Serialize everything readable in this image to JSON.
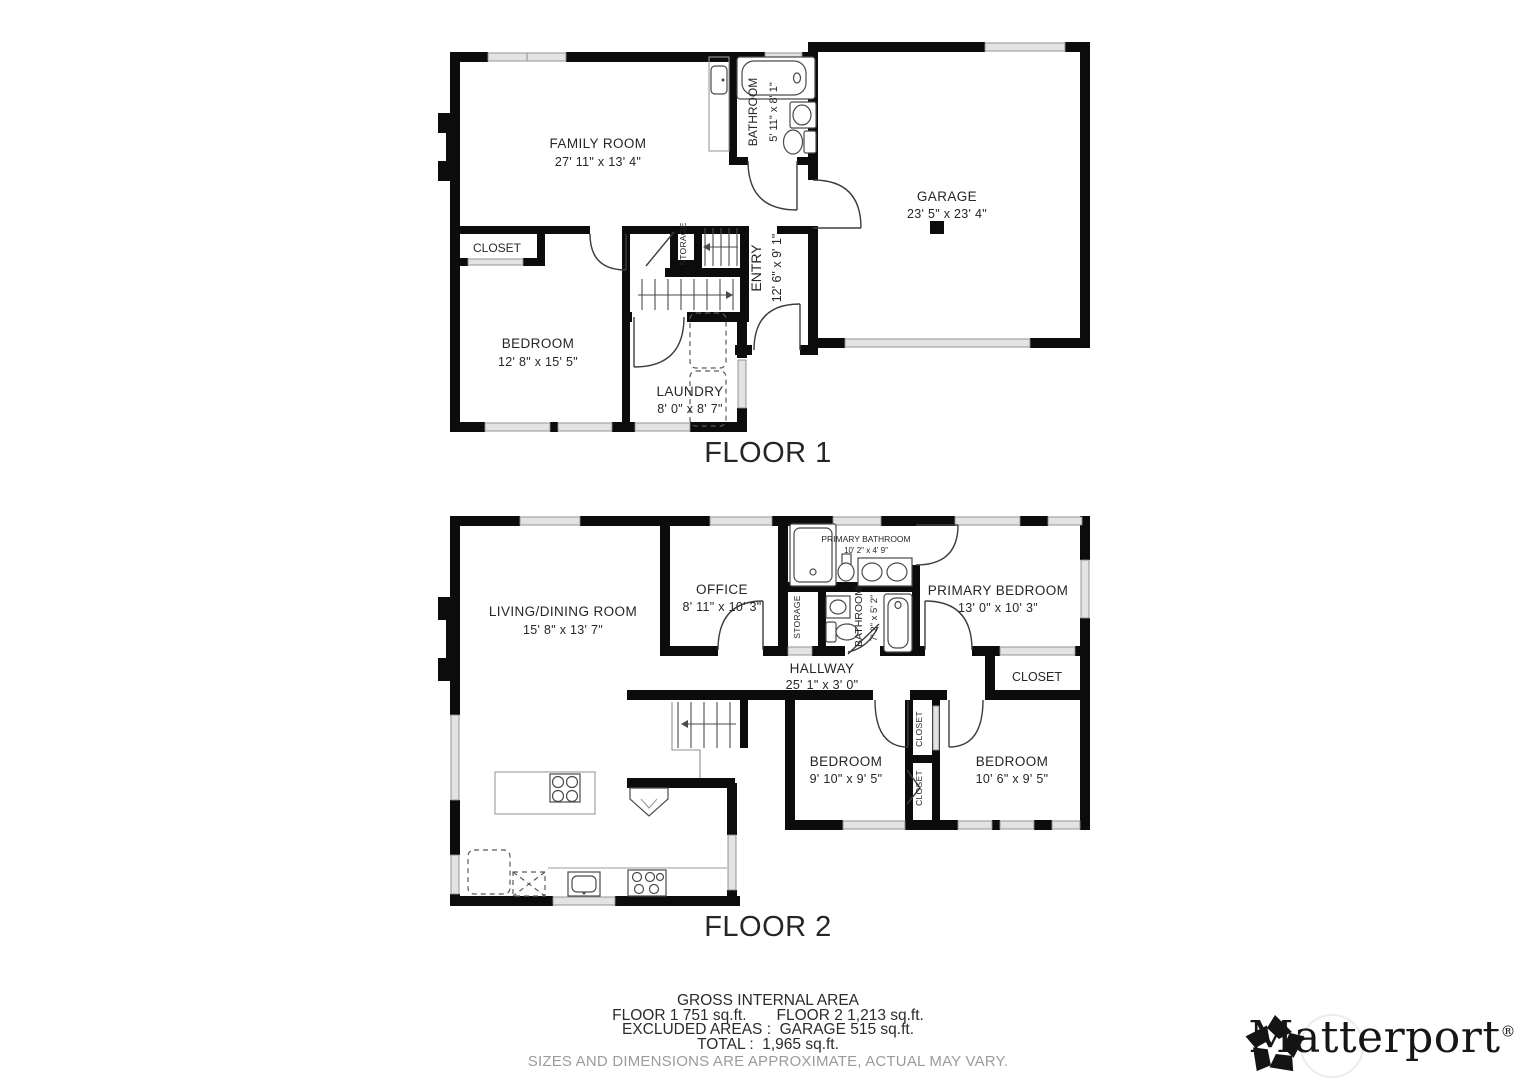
{
  "floor1": {
    "title": "FLOOR 1",
    "rooms": {
      "family_room": {
        "name": "FAMILY ROOM",
        "dims": "27' 11\" x 13' 4\""
      },
      "bathroom": {
        "name": "BATHROOM",
        "dims": "5' 11\" x 8' 1\""
      },
      "garage": {
        "name": "GARAGE",
        "dims": "23' 5\" x 23' 4\""
      },
      "closet": {
        "name": "CLOSET"
      },
      "bedroom": {
        "name": "BEDROOM",
        "dims": "12' 8\" x 15' 5\""
      },
      "laundry": {
        "name": "LAUNDRY",
        "dims": "8' 0\" x 8' 7\""
      },
      "entry": {
        "name": "ENTRY",
        "dims": "12' 6\" x 9' 1\""
      },
      "storage": {
        "name": "STORAGE"
      }
    }
  },
  "floor2": {
    "title": "FLOOR 2",
    "rooms": {
      "living_dining": {
        "name": "LIVING/DINING ROOM",
        "dims": "15' 8\" x 13' 7\""
      },
      "office": {
        "name": "OFFICE",
        "dims": "8' 11\" x 10' 3\""
      },
      "primary_bathroom": {
        "name": "PRIMARY BATHROOM",
        "dims": "10' 2\" x 4' 9\""
      },
      "primary_bedroom": {
        "name": "PRIMARY BEDROOM",
        "dims": "13' 0\" x 10' 3\""
      },
      "storage": {
        "name": "STORAGE"
      },
      "bathroom": {
        "name": "BATHROOM",
        "dims": "7' 2\" x 5' 2\""
      },
      "hallway": {
        "name": "HALLWAY",
        "dims": "25' 1\" x 3' 0\""
      },
      "closet_primary": {
        "name": "CLOSET"
      },
      "bedroom_a": {
        "name": "BEDROOM",
        "dims": "9' 10\" x 9' 5\""
      },
      "bedroom_b": {
        "name": "BEDROOM",
        "dims": "10' 6\" x 9' 5\""
      },
      "closet_a": {
        "name": "CLOSET"
      },
      "closet_b": {
        "name": "CLOSET"
      }
    }
  },
  "footer": {
    "gross_title": "GROSS INTERNAL AREA",
    "floor1_area": "FLOOR 1 751 sq.ft.",
    "floor2_area": "FLOOR 2 1,213 sq.ft.",
    "excluded": "EXCLUDED AREAS :  GARAGE 515 sq.ft.",
    "total": "TOTAL :  1,965 sq.ft.",
    "disclaimer": "SIZES AND DIMENSIONS ARE APPROXIMATE, ACTUAL MAY VARY."
  },
  "branding": {
    "name": "Matterport",
    "registered": "®"
  }
}
